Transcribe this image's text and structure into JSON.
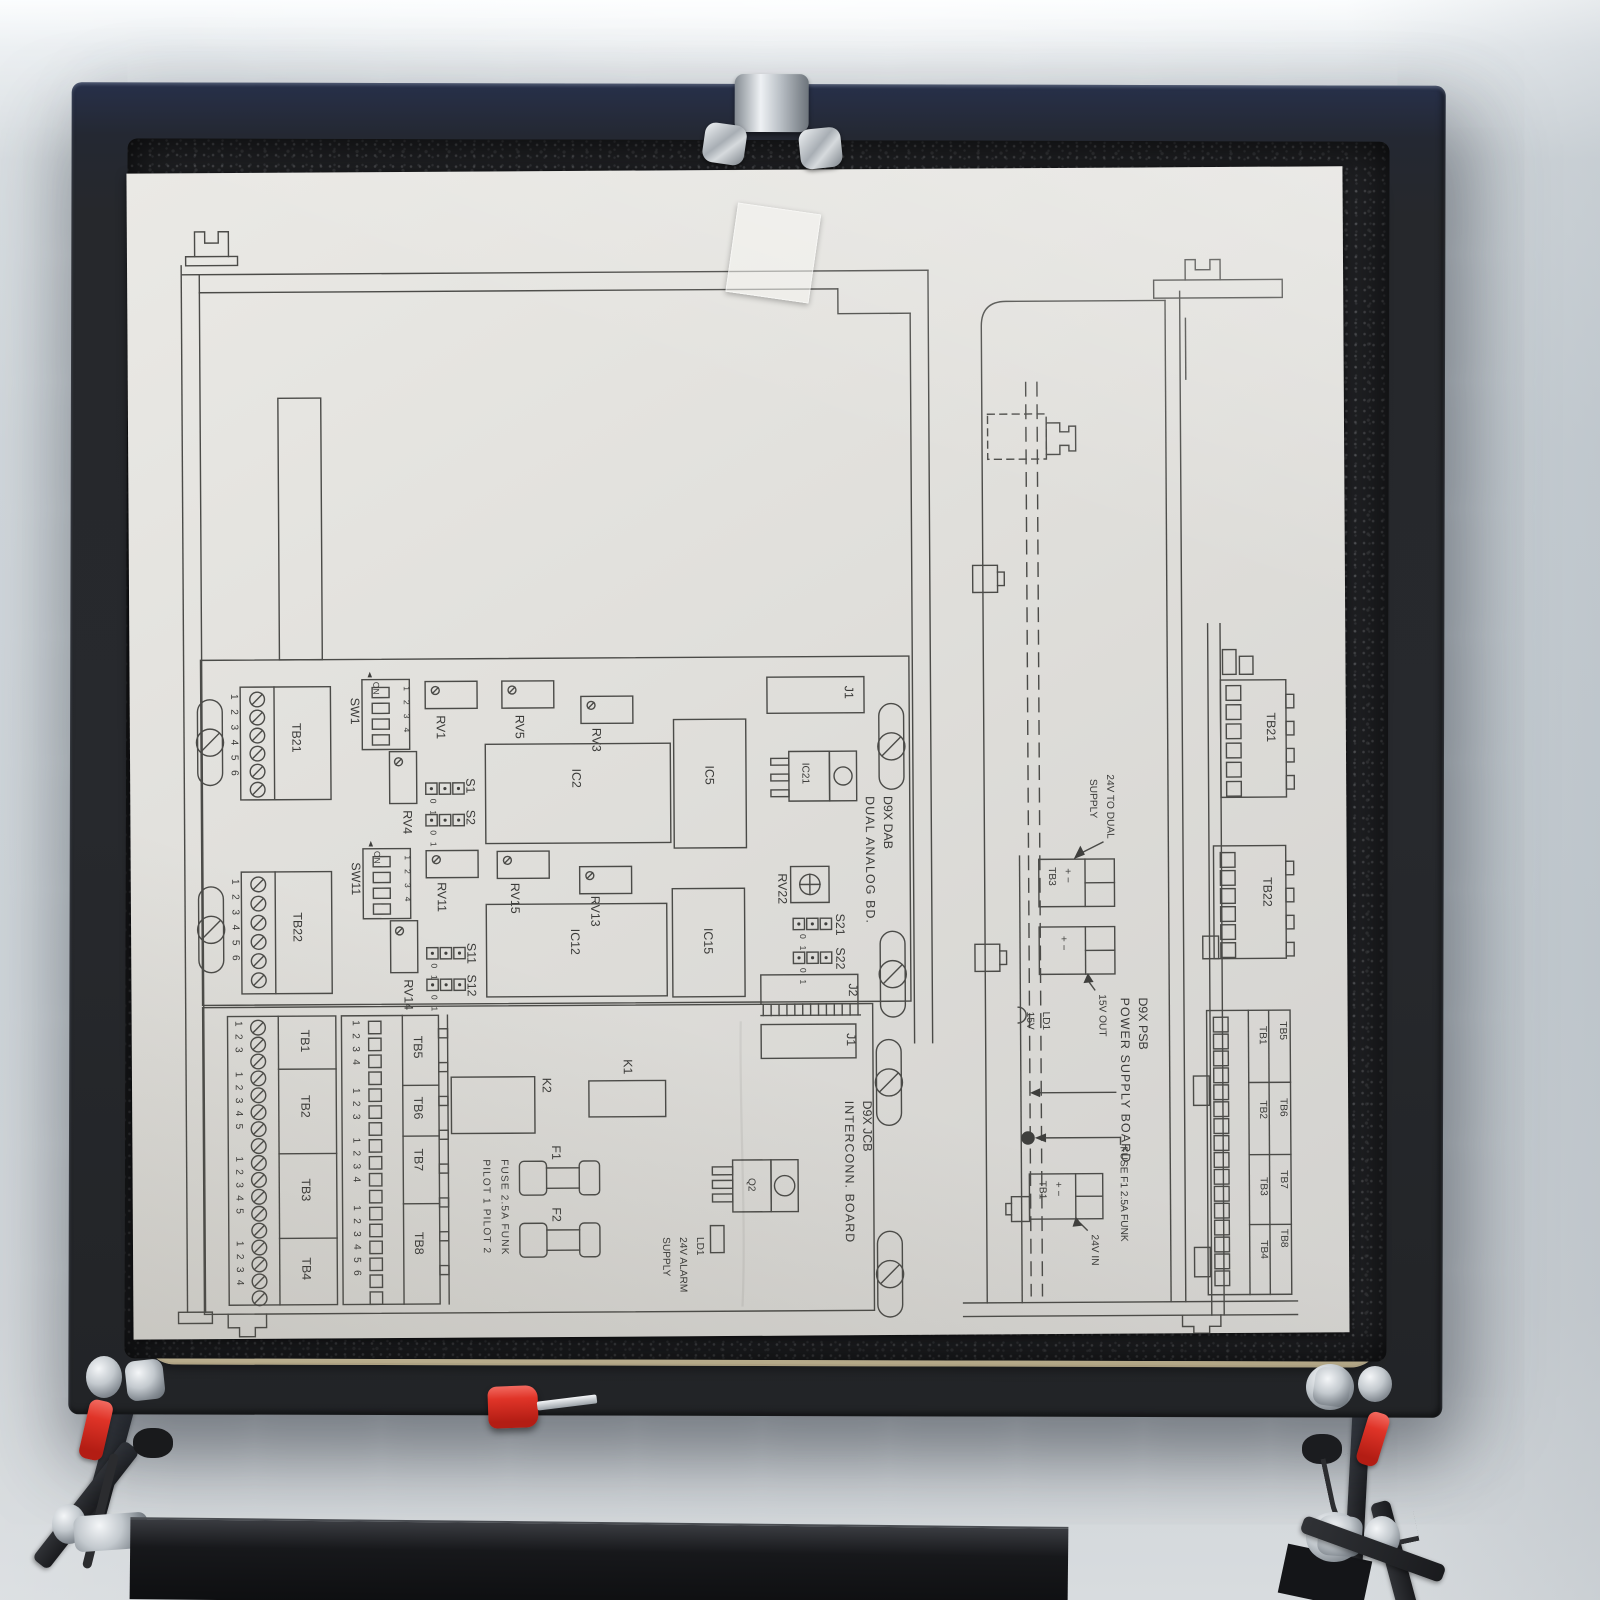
{
  "scene": {
    "colors": {
      "wall": "#cbd2d7",
      "door": "#26282c",
      "gasket": "#eae2c8",
      "foam": "#1f2023",
      "paper": "#e0dfdb",
      "ink": "#4b4b48",
      "metal": "#c3c9ce",
      "ferrule_red": "#d42a22"
    }
  },
  "diagram": {
    "dab": {
      "title1": "D9X DAB",
      "title2": "DUAL ANALOG BD.",
      "j1": "J1",
      "j2": "J2",
      "ic21": "IC21",
      "rv22": "RV22",
      "s1": "S1",
      "s2": "S2",
      "s11": "S11",
      "s12": "S12",
      "s21": "S21",
      "s22": "S22",
      "j01": "0 1",
      "tb21": "TB21",
      "tb21_pins": "1 2 3 4 5 6",
      "tb22": "TB22",
      "tb22_pins": "1 2 3 4 5 6",
      "sw1": "SW1",
      "sw11": "SW11",
      "dip_on": "ON",
      "dip_pos": "1 2 3 4",
      "rv1": "RV1",
      "rv3": "RV3",
      "rv4": "RV4",
      "rv5": "RV5",
      "rv11": "RV11",
      "rv13": "RV13",
      "rv14": "RV14",
      "rv15": "RV15",
      "ic2": "IC2",
      "ic5": "IC5",
      "ic12": "IC12",
      "ic15": "IC15"
    },
    "jcb": {
      "title1": "D9X JCB",
      "title2": "INTERCONN. BOARD",
      "j1": "J1",
      "k1": "K1",
      "k2": "K2",
      "f1": "F1",
      "f2": "F2",
      "q2": "Q2",
      "fuse_note": "FUSE 2.5A FUNK",
      "pilot_note": "PILOT 1  PILOT 2",
      "ld1_line1": "LD1",
      "ld1_line2": "24V ALARM",
      "ld1_line3": "SUPPLY",
      "tb1": "TB1",
      "tb1_pins": "1 2 3",
      "tb2": "TB2",
      "tb2_pins": "1 2 3 4 5",
      "tb3": "TB3",
      "tb3_pins": "1 2 3 4 5",
      "tb4": "TB4",
      "tb4_pins": "1 2 3 4",
      "tb5": "TB5",
      "tb5_pins": "1 2 3 4",
      "tb6": "TB6",
      "tb6_pins": "1 2 3",
      "tb7": "TB7",
      "tb7_pins": "1 2 3 4",
      "tb8": "TB8",
      "tb8_pins": "1 2 3 4 5 6"
    },
    "psb": {
      "title1": "D9X PSB",
      "title2": "POWER SUPPLY BOARD",
      "n24_1": "24V TO DUAL",
      "n24_2": "SUPPLY",
      "tb3": "TB3",
      "pm": "+ −",
      "n15": "15V OUT",
      "ld1": "LD1",
      "v15": "15V",
      "fuse": "FUSE F1 2.5A FUNK",
      "tb1": "TB1",
      "n24in": "24V IN",
      "tb21": "TB21",
      "tb22": "TB22",
      "inner": [
        "TB1",
        "TB2",
        "TB3",
        "TB4"
      ],
      "outer": [
        "TB5",
        "TB6",
        "TB7",
        "TB8"
      ]
    }
  }
}
